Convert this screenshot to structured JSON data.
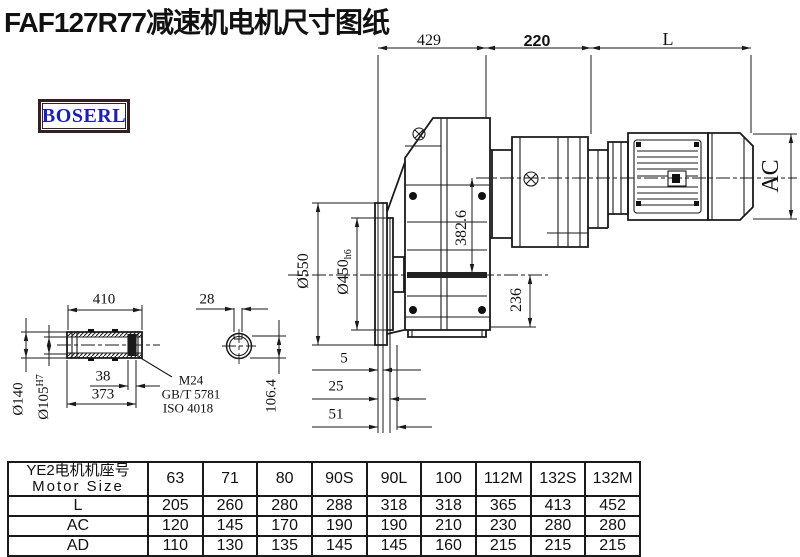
{
  "title": "FAF127R77减速机电机尺寸图纸",
  "logo": {
    "text": "BOSERL"
  },
  "dims": {
    "d429": "429",
    "d220": "220",
    "dL": "L",
    "dAC": "AC",
    "phi550": "Ø550",
    "phi450": "Ø450",
    "phi450_suffix": "h6",
    "d382": "382.6",
    "d236": "236",
    "d410": "410",
    "d28": "28",
    "phi140": "Ø140",
    "phi105": "Ø105",
    "phi105_suffix": "H7",
    "d38": "38",
    "d373": "373",
    "d5": "5",
    "d25": "25",
    "d51": "51",
    "d106": "106.4",
    "m24": "M24",
    "gbt": "GB/T 5781",
    "iso": "ISO 4018"
  },
  "table": {
    "header_cn": "YE2电机机座号",
    "header_en": "Motor Size",
    "columns": [
      "63",
      "71",
      "80",
      "90S",
      "90L",
      "100",
      "112M",
      "132S",
      "132M"
    ],
    "rows": [
      {
        "label": "L",
        "values": [
          "205",
          "260",
          "280",
          "288",
          "318",
          "318",
          "365",
          "413",
          "452"
        ]
      },
      {
        "label": "AC",
        "values": [
          "120",
          "145",
          "170",
          "190",
          "190",
          "210",
          "230",
          "280",
          "280"
        ]
      },
      {
        "label": "AD",
        "values": [
          "110",
          "130",
          "135",
          "145",
          "145",
          "160",
          "215",
          "215",
          "215"
        ]
      }
    ]
  }
}
